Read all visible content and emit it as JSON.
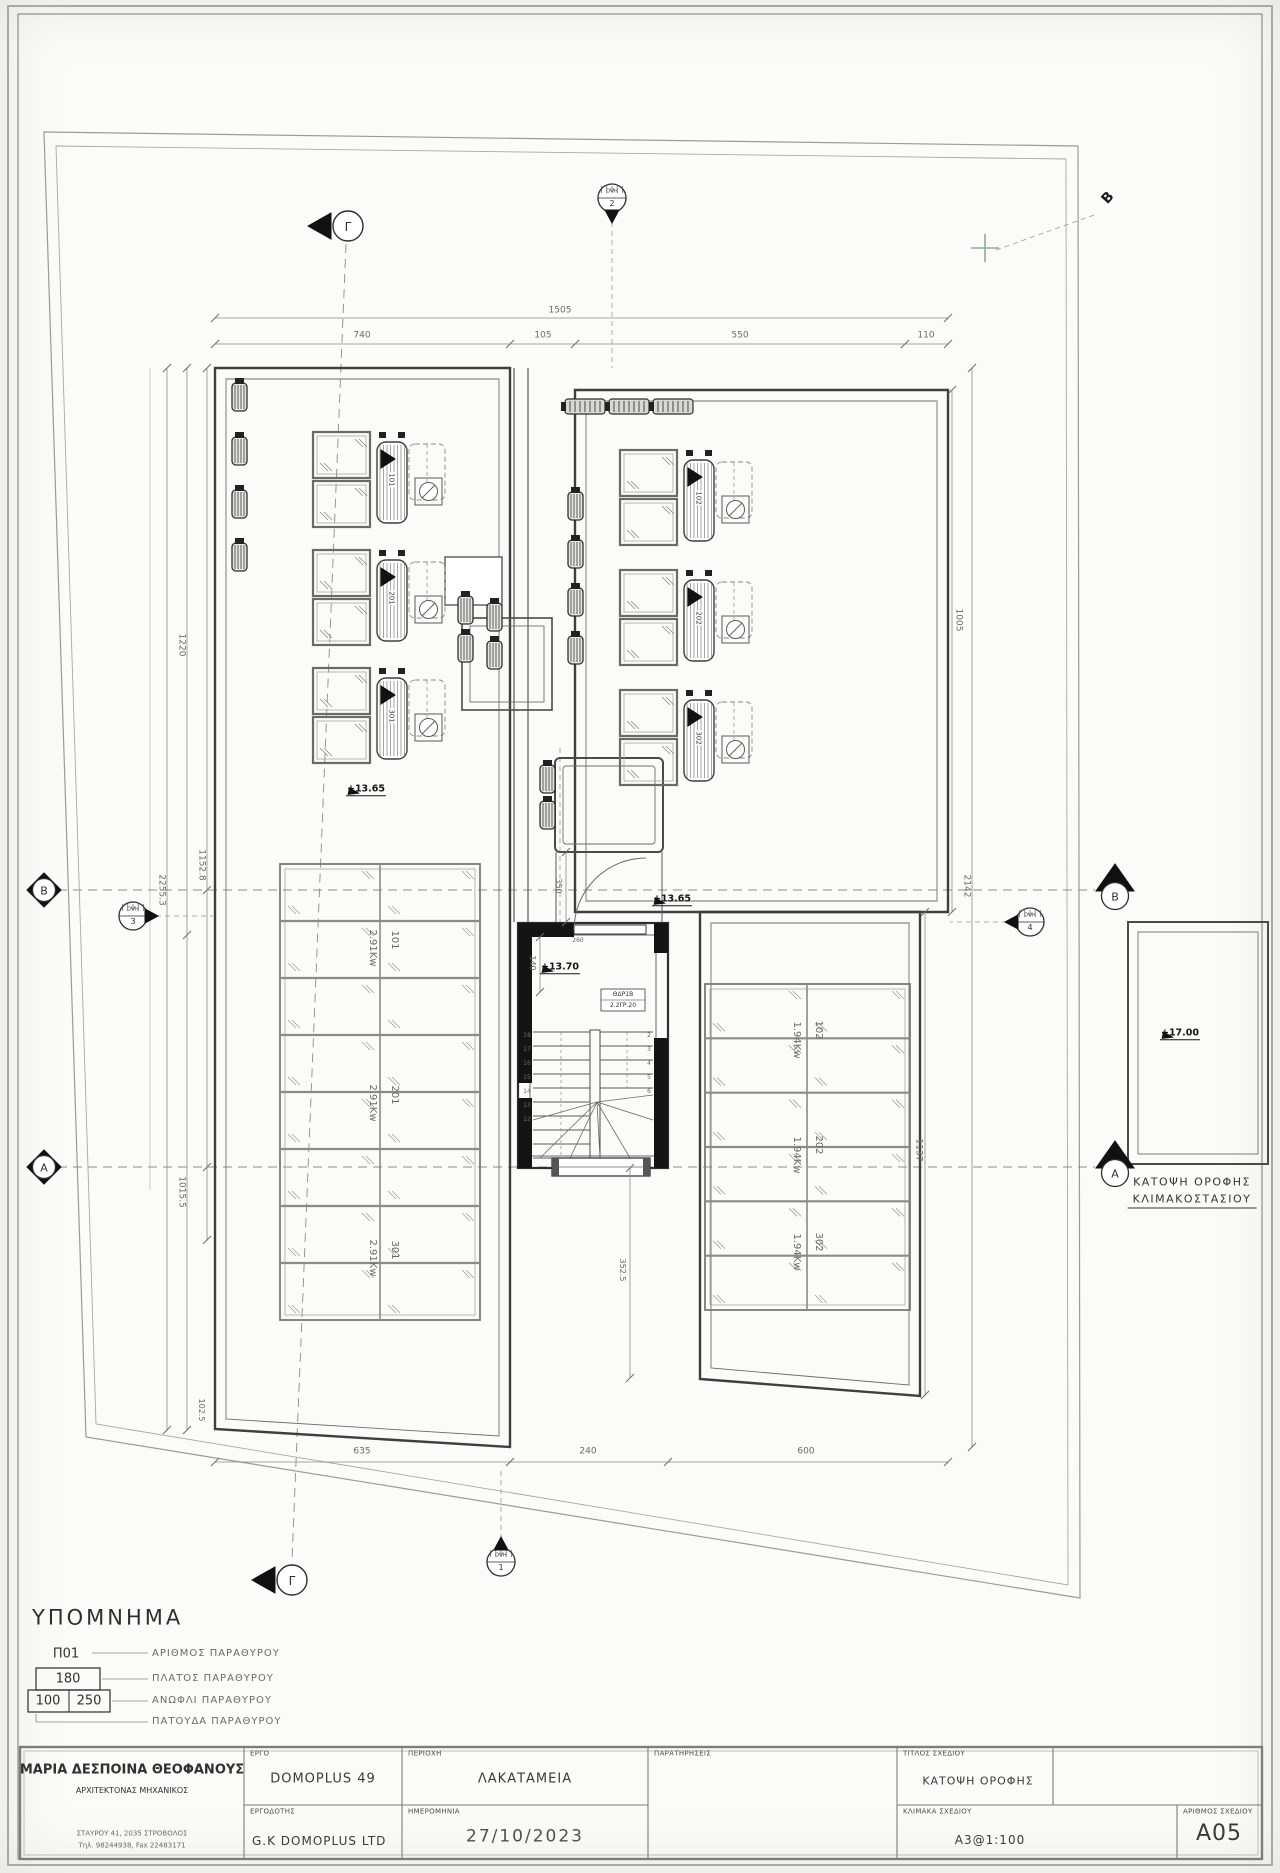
{
  "markers": {
    "gamma": "Γ",
    "b_left": "B",
    "a_left": "A",
    "b_right": "B",
    "a_right": "A",
    "b_corner": "B",
    "views": [
      {
        "name": "ΟΨΗ",
        "num": "1"
      },
      {
        "name": "ΟΨΗ",
        "num": "2"
      },
      {
        "name": "ΟΨΗ",
        "num": "3"
      },
      {
        "name": "ΟΨΗ",
        "num": "4"
      }
    ]
  },
  "levels": {
    "roof_left": "+13.65",
    "roof_right": "+13.65",
    "stair_landing": "+13.70",
    "stair_roof": "+17.00"
  },
  "solar_units": {
    "left": [
      "101",
      "201",
      "301"
    ],
    "right": [
      "102",
      "202",
      "302"
    ]
  },
  "pv_arrays": {
    "left": [
      {
        "id": "101",
        "power": "2.91Kw"
      },
      {
        "id": "201",
        "power": "2.91Kw"
      },
      {
        "id": "301",
        "power": "2.91Kw"
      }
    ],
    "right": [
      {
        "id": "102",
        "power": "1.94Kw"
      },
      {
        "id": "202",
        "power": "1.94Kw"
      },
      {
        "id": "302",
        "power": "1.94Kw"
      }
    ]
  },
  "stair": {
    "door_tag_top": "ΘΔΡ1Β",
    "door_tag_bottom": "2.2ΓΡ.20",
    "steps_left": [
      "18",
      "17",
      "16",
      "15",
      "14",
      "13",
      "12"
    ],
    "steps_right": [
      "2",
      "3",
      "4",
      "5",
      "6"
    ]
  },
  "dimensions": {
    "top_total": "1505",
    "top": [
      "740",
      "105",
      "550",
      "110"
    ],
    "left": [
      "1220",
      "2255.3",
      "1152.8",
      "1015.5",
      "102.5"
    ],
    "right": [
      "1005",
      "2142",
      "1137"
    ],
    "bottom": [
      "635",
      "240",
      "600"
    ],
    "stair": [
      "350",
      "140",
      "260",
      "352.5"
    ]
  },
  "caption": {
    "line1": "ΚΑΤΟΨΗ ΟΡΟΦΗΣ",
    "line2": "ΚΛΙΜΑΚΟΣΤΑΣΙΟΥ"
  },
  "legend": {
    "title": "ΥΠΟΜΝΗΜΑ",
    "tag_number": "Π01",
    "tag_width": "180",
    "tag_lintel_a": "100",
    "tag_lintel_b": "250",
    "items": [
      "ΑΡΙΘΜΟΣ ΠΑΡΑΘΥΡΟΥ",
      "ΠΛΑΤΟΣ ΠΑΡΑΘΥΡΟΥ",
      "ΑΝΩΦΛΙ ΠΑΡΑΘΥΡΟΥ",
      "ΠΑΤΟΥΔΑ ΠΑΡΑΘΥΡΟΥ"
    ]
  },
  "title_block": {
    "architect_name": "ΜΑΡΙΑ ΔΕΣΠΟΙΝΑ ΘΕΟΦΑΝΟΥΣ",
    "architect_role": "ΑΡΧΙΤΕΚΤΟΝΑΣ ΜΗΧΑΝΙΚΟΣ",
    "architect_address": "ΣΤΑΥΡΟΥ 41, 2035 ΣΤΡΟΒΟΛΟΣ",
    "architect_phone": "Τηλ. 98244938, Fax 22483171",
    "labels": {
      "project": "ΕΡΓΟ",
      "area": "ΠΕΡΙΟΧΗ",
      "notes": "ΠΑΡΑΤΗΡΗΣΕΙΣ",
      "title": "ΤΙΤΛΟΣ ΣΧΕΔΙΟΥ",
      "client": "ΕΡΓΟΔΟΤΗΣ",
      "date": "ΗΜΕΡΟΜΗΝΙΑ",
      "scale": "ΚΛΙΜΑΚΑ ΣΧΕΔΙΟΥ",
      "number": "ΑΡΙΘΜΟΣ ΣΧΕΔΙΟΥ"
    },
    "values": {
      "project": "DOMOPLUS 49",
      "area": "ΛΑΚΑΤΑΜΕΙΑ",
      "title": "ΚΑΤΟΨΗ ΟΡΟΦΗΣ",
      "client": "G.K DOMOPLUS LTD",
      "date": "27/10/2023",
      "scale": "A3@1:100",
      "number": "A05"
    }
  }
}
